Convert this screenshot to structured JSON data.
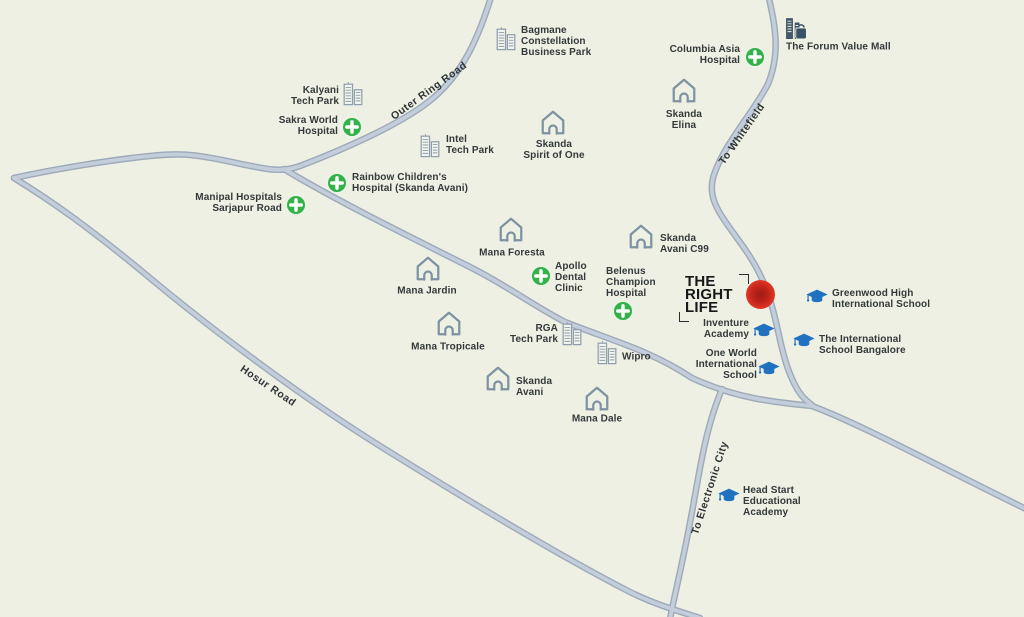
{
  "map": {
    "colors": {
      "background": "#eef0e3",
      "road": "#c4cdda",
      "road_casing": "#9daaba",
      "hospital_green": "#35b14a",
      "school_blue": "#2171c1",
      "landmark_gray": "#7e93a2",
      "mall_navy": "#44586b",
      "project_red": "#d6301f",
      "text": "#34393c"
    },
    "road_labels": [
      {
        "name": "outer-ring-road",
        "text": "Outer Ring Road",
        "x": 429,
        "y": 91,
        "rotate": -36
      },
      {
        "name": "to-whitefield",
        "text": "To Whitefield",
        "x": 742,
        "y": 134,
        "rotate": -55
      },
      {
        "name": "hosur-road",
        "text": "Hosur Road",
        "x": 268,
        "y": 386,
        "rotate": 34
      },
      {
        "name": "to-electronic-city",
        "text": "To Electronic City",
        "x": 710,
        "y": 488,
        "rotate": -72
      }
    ],
    "markers": [
      {
        "name": "bagmane-constellation-business-park",
        "kind": "techpark",
        "icon": {
          "x": 506,
          "y": 38
        },
        "label": {
          "lines": [
            "Bagmane",
            "Constellation",
            "Business Park"
          ],
          "x": 521,
          "y": 42,
          "align": "left"
        }
      },
      {
        "name": "kalyani-tech-park",
        "kind": "techpark",
        "icon": {
          "x": 353,
          "y": 93
        },
        "label": {
          "lines": [
            "Kalyani",
            "Tech Park"
          ],
          "x": 339,
          "y": 97,
          "align": "right"
        }
      },
      {
        "name": "sakra-world-hospital",
        "kind": "hospital",
        "icon": {
          "x": 352,
          "y": 127
        },
        "label": {
          "lines": [
            "Sakra World",
            "Hospital"
          ],
          "x": 338,
          "y": 127,
          "align": "right"
        }
      },
      {
        "name": "intel-tech-park",
        "kind": "techpark",
        "icon": {
          "x": 430,
          "y": 145
        },
        "label": {
          "lines": [
            "Intel",
            "Tech Park"
          ],
          "x": 446,
          "y": 146,
          "align": "left"
        }
      },
      {
        "name": "skanda-spirit-of-one",
        "kind": "residence",
        "icon": {
          "x": 553,
          "y": 122
        },
        "label": {
          "lines": [
            "Skanda",
            "Spirit of One"
          ],
          "x": 554,
          "y": 151,
          "align": "center"
        }
      },
      {
        "name": "columbia-asia-hospital",
        "kind": "hospital",
        "icon": {
          "x": 755,
          "y": 57
        },
        "label": {
          "lines": [
            "Columbia Asia",
            "Hospital"
          ],
          "x": 740,
          "y": 56,
          "align": "right"
        }
      },
      {
        "name": "the-forum-value-mall",
        "kind": "mall",
        "icon": {
          "x": 796,
          "y": 29
        },
        "label": {
          "lines": [
            "The Forum Value Mall"
          ],
          "x": 786,
          "y": 48,
          "align": "left"
        }
      },
      {
        "name": "skanda-elina",
        "kind": "residence",
        "icon": {
          "x": 684,
          "y": 90
        },
        "label": {
          "lines": [
            "Skanda",
            "Elina"
          ],
          "x": 684,
          "y": 121,
          "align": "center"
        }
      },
      {
        "name": "manipal-hospitals-sarjapur-road",
        "kind": "hospital",
        "icon": {
          "x": 296,
          "y": 205
        },
        "label": {
          "lines": [
            "Manipal Hospitals",
            "Sarjapur Road"
          ],
          "x": 282,
          "y": 204,
          "align": "right"
        }
      },
      {
        "name": "rainbow-childrens-hospital",
        "kind": "hospital",
        "icon": {
          "x": 337,
          "y": 183
        },
        "label": {
          "lines": [
            "Rainbow Children's",
            "Hospital (Skanda Avani)"
          ],
          "x": 352,
          "y": 184,
          "align": "left"
        }
      },
      {
        "name": "mana-foresta",
        "kind": "residence",
        "icon": {
          "x": 511,
          "y": 229
        },
        "label": {
          "lines": [
            "Mana Foresta"
          ],
          "x": 512,
          "y": 254,
          "align": "center"
        }
      },
      {
        "name": "apollo-dental-clinic",
        "kind": "hospital",
        "icon": {
          "x": 541,
          "y": 276
        },
        "label": {
          "lines": [
            "Apollo",
            "Dental",
            "Clinic"
          ],
          "x": 555,
          "y": 278,
          "align": "left"
        }
      },
      {
        "name": "belenus-champion-hospital",
        "kind": "hospital",
        "icon": {
          "x": 623,
          "y": 311
        },
        "label": {
          "lines": [
            "Belenus",
            "Champion",
            "Hospital"
          ],
          "x": 606,
          "y": 283,
          "align": "left"
        }
      },
      {
        "name": "skanda-avani-c99",
        "kind": "residence",
        "icon": {
          "x": 641,
          "y": 236
        },
        "label": {
          "lines": [
            "Skanda",
            "Avani C99"
          ],
          "x": 660,
          "y": 245,
          "align": "left"
        }
      },
      {
        "name": "greenwood-high-international-school",
        "kind": "school",
        "icon": {
          "x": 817,
          "y": 297
        },
        "label": {
          "lines": [
            "Greenwood High",
            "International School"
          ],
          "x": 832,
          "y": 300,
          "align": "left"
        }
      },
      {
        "name": "inventure-academy",
        "kind": "school",
        "icon": {
          "x": 764,
          "y": 331
        },
        "label": {
          "lines": [
            "Inventure",
            "Academy"
          ],
          "x": 749,
          "y": 330,
          "align": "right"
        }
      },
      {
        "name": "the-international-school-bangalore",
        "kind": "school",
        "icon": {
          "x": 804,
          "y": 341
        },
        "label": {
          "lines": [
            "The International",
            "School Bangalore"
          ],
          "x": 819,
          "y": 346,
          "align": "left"
        }
      },
      {
        "name": "one-world-international-school",
        "kind": "school",
        "icon": {
          "x": 769,
          "y": 369
        },
        "label": {
          "lines": [
            "One World",
            "International",
            "School"
          ],
          "x": 757,
          "y": 365,
          "align": "right"
        }
      },
      {
        "name": "mana-jardin",
        "kind": "residence",
        "icon": {
          "x": 428,
          "y": 268
        },
        "label": {
          "lines": [
            "Mana Jardin"
          ],
          "x": 427,
          "y": 292,
          "align": "center"
        }
      },
      {
        "name": "mana-tropicale",
        "kind": "residence",
        "icon": {
          "x": 449,
          "y": 323
        },
        "label": {
          "lines": [
            "Mana Tropicale"
          ],
          "x": 448,
          "y": 348,
          "align": "center"
        }
      },
      {
        "name": "rga-tech-park",
        "kind": "techpark",
        "icon": {
          "x": 572,
          "y": 333
        },
        "label": {
          "lines": [
            "RGA",
            "Tech Park"
          ],
          "x": 558,
          "y": 335,
          "align": "right"
        }
      },
      {
        "name": "wipro",
        "kind": "techpark",
        "icon": {
          "x": 607,
          "y": 352
        },
        "label": {
          "lines": [
            "Wipro"
          ],
          "x": 622,
          "y": 358,
          "align": "left"
        }
      },
      {
        "name": "skanda-avani",
        "kind": "residence",
        "icon": {
          "x": 498,
          "y": 378
        },
        "label": {
          "lines": [
            "Skanda",
            "Avani"
          ],
          "x": 516,
          "y": 388,
          "align": "left"
        }
      },
      {
        "name": "mana-dale",
        "kind": "residence",
        "icon": {
          "x": 597,
          "y": 398
        },
        "label": {
          "lines": [
            "Mana Dale"
          ],
          "x": 597,
          "y": 420,
          "align": "center"
        }
      },
      {
        "name": "head-start-educational-academy",
        "kind": "school",
        "icon": {
          "x": 729,
          "y": 496
        },
        "label": {
          "lines": [
            "Head Start",
            "Educational",
            "Academy"
          ],
          "x": 743,
          "y": 502,
          "align": "left"
        }
      }
    ],
    "project": {
      "name": "THE RIGHT LIFE",
      "logo_lines": [
        "THE",
        "RIGHT",
        "LIFE"
      ],
      "dot": {
        "x": 760,
        "y": 294
      }
    }
  }
}
